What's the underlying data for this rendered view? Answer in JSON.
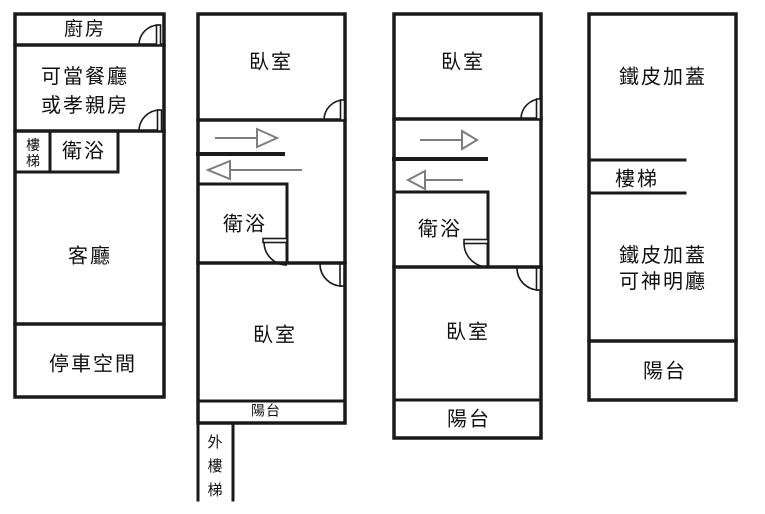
{
  "title": "floor-plan",
  "colors": {
    "wall": "#1a1a1a",
    "arrow": "#7d7d7d",
    "background": "#ffffff"
  },
  "icons": {
    "stair_up_arrow": "→",
    "stair_down_arrow": "←",
    "door": "quarter-arc"
  },
  "units": [
    {
      "id": "unit-1",
      "rooms": {
        "kitchen": "廚房",
        "dining": "可當餐廳\n或孝親房",
        "stairs": "樓\n梯",
        "bath": "衛浴",
        "living": "客廳",
        "parking": "停車空間"
      }
    },
    {
      "id": "unit-2",
      "rooms": {
        "bedroom_upper": "臥室",
        "bath": "衛浴",
        "bedroom_lower": "臥室",
        "balcony": "陽台",
        "outer_stairs": "外\n樓\n梯"
      }
    },
    {
      "id": "unit-3",
      "rooms": {
        "bedroom_upper": "臥室",
        "bath": "衛浴",
        "bedroom_lower": "臥室",
        "balcony": "陽台"
      }
    },
    {
      "id": "unit-4",
      "rooms": {
        "rooftop": "鐵皮加蓋",
        "stairs": "樓梯",
        "shrine": "鐵皮加蓋\n可神明廳",
        "balcony": "陽台"
      }
    }
  ]
}
